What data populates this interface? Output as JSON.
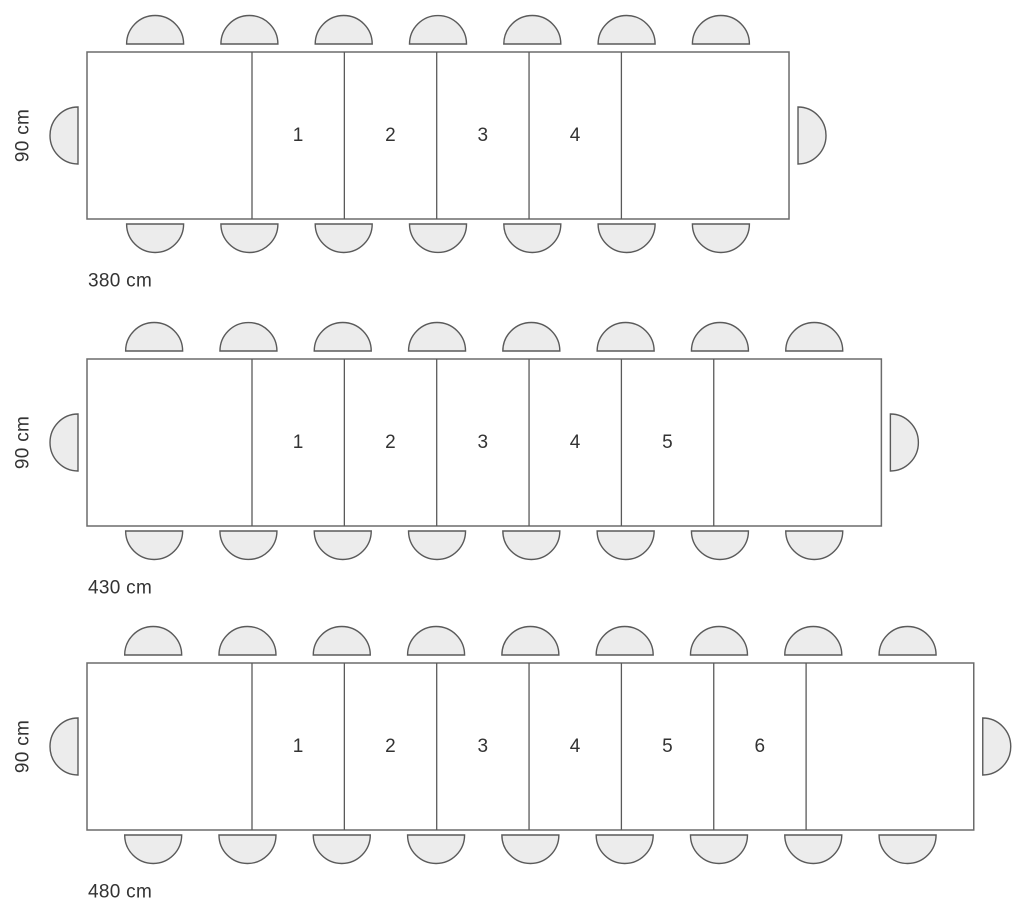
{
  "colors": {
    "background": "#ffffff",
    "table_fill": "#ffffff",
    "table_stroke": "#6b6b6b",
    "divider_stroke": "#5a5a5a",
    "chair_fill": "#ececec",
    "chair_stroke": "#5a5a5a",
    "label_text": "#333333"
  },
  "diagram": {
    "unit": "cm",
    "tables": [
      {
        "name": "extendable-table-380",
        "length_cm": 380,
        "depth_cm": 90,
        "length_label": "380 cm",
        "depth_label": "90 cm",
        "extension_leaves": [
          "1",
          "2",
          "3",
          "4"
        ],
        "seats": {
          "top": 7,
          "bottom": 7,
          "left": 1,
          "right": 1
        }
      },
      {
        "name": "extendable-table-430",
        "length_cm": 430,
        "depth_cm": 90,
        "length_label": "430 cm",
        "depth_label": "90 cm",
        "extension_leaves": [
          "1",
          "2",
          "3",
          "4",
          "5"
        ],
        "seats": {
          "top": 8,
          "bottom": 8,
          "left": 1,
          "right": 1
        }
      },
      {
        "name": "extendable-table-480",
        "length_cm": 480,
        "depth_cm": 90,
        "length_label": "480 cm",
        "depth_label": "90 cm",
        "extension_leaves": [
          "1",
          "2",
          "3",
          "4",
          "5",
          "6"
        ],
        "seats": {
          "top": 9,
          "bottom": 9,
          "left": 1,
          "right": 1
        }
      }
    ]
  }
}
